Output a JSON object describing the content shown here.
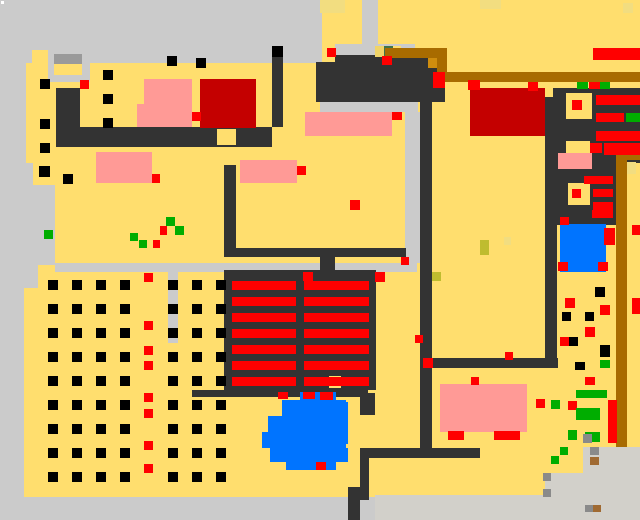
{
  "canvas": {
    "w": 640,
    "h": 520
  },
  "palette": {
    "floor": "#ffde6e",
    "path": "#cbcbcb",
    "path2": "#d2d0ca",
    "roof": "#9a9a9a",
    "wall": "#333333",
    "bed": "#ff9a96",
    "carpet": "#c40000",
    "item": "#ff0000",
    "plant": "#00ad00",
    "water": "#0074ff",
    "wood": "#a86b00",
    "wood2": "#cf8d0e",
    "moss": "#41744a",
    "hay": "#bfbc2f",
    "sand": "#f2dd80",
    "khaki": "#f0d468",
    "rock": "#8a8a8a",
    "dirt": "#a06a32",
    "crop": "#000000",
    "white": "#ffffff"
  },
  "rects": [
    [
      0,
      0,
      640,
      520,
      "floor"
    ],
    [
      0,
      0,
      322,
      63,
      "path"
    ],
    [
      0,
      63,
      26,
      100,
      "path"
    ],
    [
      0,
      163,
      33,
      22,
      "path"
    ],
    [
      0,
      185,
      55,
      80,
      "path"
    ],
    [
      0,
      265,
      38,
      23,
      "path"
    ],
    [
      0,
      288,
      24,
      210,
      "path"
    ],
    [
      0,
      497,
      640,
      23,
      "path"
    ],
    [
      375,
      495,
      265,
      25,
      "path2"
    ],
    [
      583,
      447,
      57,
      50,
      "path2"
    ],
    [
      545,
      473,
      95,
      24,
      "path2"
    ],
    [
      32,
      50,
      16,
      13,
      "floor"
    ],
    [
      48,
      52,
      42,
      30,
      "path"
    ],
    [
      54,
      54,
      28,
      10,
      "roof"
    ],
    [
      54,
      64,
      28,
      11,
      "floor"
    ],
    [
      362,
      0,
      16,
      48,
      "path"
    ],
    [
      335,
      44,
      80,
      18,
      "path"
    ],
    [
      320,
      102,
      98,
      10,
      "path"
    ],
    [
      405,
      112,
      15,
      151,
      "path"
    ],
    [
      55,
      263,
      362,
      9,
      "path"
    ],
    [
      168,
      272,
      10,
      71,
      "path"
    ],
    [
      56,
      88,
      24,
      39,
      "wall"
    ],
    [
      56,
      127,
      216,
      20,
      "wall"
    ],
    [
      224,
      165,
      12,
      83,
      "wall"
    ],
    [
      316,
      62,
      129,
      40,
      "wall"
    ],
    [
      335,
      55,
      95,
      8,
      "wall"
    ],
    [
      272,
      57,
      11,
      70,
      "wall"
    ],
    [
      224,
      248,
      182,
      9,
      "wall"
    ],
    [
      320,
      248,
      15,
      24,
      "wall"
    ],
    [
      420,
      93,
      12,
      357,
      "wall"
    ],
    [
      432,
      358,
      126,
      10,
      "wall"
    ],
    [
      545,
      97,
      12,
      271,
      "wall"
    ],
    [
      553,
      88,
      87,
      74,
      "wall"
    ],
    [
      555,
      162,
      62,
      63,
      "wall"
    ],
    [
      366,
      448,
      114,
      10,
      "wall"
    ],
    [
      360,
      448,
      9,
      52,
      "wall"
    ],
    [
      348,
      487,
      12,
      33,
      "wall"
    ],
    [
      192,
      390,
      176,
      7,
      "wall"
    ],
    [
      360,
      393,
      15,
      22,
      "wall"
    ],
    [
      224,
      270,
      152,
      120,
      "wall"
    ],
    [
      617,
      135,
      23,
      28,
      "wall"
    ],
    [
      217,
      129,
      19,
      16,
      "floor"
    ],
    [
      297,
      129,
      13,
      16,
      "floor"
    ],
    [
      329,
      376,
      12,
      12,
      "floor"
    ],
    [
      566,
      93,
      26,
      26,
      "floor"
    ],
    [
      568,
      183,
      22,
      22,
      "floor"
    ],
    [
      566,
      141,
      24,
      13,
      "floor"
    ],
    [
      428,
      57,
      12,
      11,
      "wood2"
    ],
    [
      375,
      46,
      9,
      11,
      "khaki"
    ],
    [
      384,
      46,
      9,
      11,
      "moss"
    ],
    [
      393,
      46,
      8,
      11,
      "floor"
    ],
    [
      385,
      48,
      62,
      10,
      "wood"
    ],
    [
      437,
      58,
      10,
      16,
      "wood"
    ],
    [
      437,
      72,
      203,
      10,
      "wood"
    ],
    [
      620,
      150,
      20,
      10,
      "wood"
    ],
    [
      616,
      150,
      11,
      297,
      "wood"
    ],
    [
      144,
      79,
      48,
      25,
      "bed"
    ],
    [
      137,
      104,
      55,
      23,
      "bed"
    ],
    [
      96,
      152,
      56,
      31,
      "bed"
    ],
    [
      240,
      160,
      57,
      23,
      "bed"
    ],
    [
      305,
      112,
      87,
      24,
      "bed"
    ],
    [
      558,
      153,
      34,
      16,
      "bed"
    ],
    [
      440,
      384,
      87,
      48,
      "bed"
    ],
    [
      200,
      79,
      56,
      49,
      "carpet"
    ],
    [
      470,
      88,
      75,
      48,
      "carpet"
    ],
    [
      232,
      281,
      64,
      9,
      "item"
    ],
    [
      232,
      297,
      64,
      9,
      "item"
    ],
    [
      232,
      313,
      64,
      9,
      "item"
    ],
    [
      232,
      329,
      64,
      9,
      "item"
    ],
    [
      232,
      345,
      64,
      9,
      "item"
    ],
    [
      232,
      361,
      64,
      9,
      "item"
    ],
    [
      232,
      377,
      64,
      9,
      "item"
    ],
    [
      304,
      281,
      65,
      9,
      "item"
    ],
    [
      304,
      297,
      65,
      9,
      "item"
    ],
    [
      304,
      313,
      65,
      9,
      "item"
    ],
    [
      304,
      329,
      65,
      9,
      "item"
    ],
    [
      304,
      345,
      65,
      9,
      "item"
    ],
    [
      304,
      361,
      65,
      9,
      "item"
    ],
    [
      304,
      377,
      65,
      9,
      "item"
    ],
    [
      596,
      95,
      44,
      10,
      "item"
    ],
    [
      596,
      113,
      28,
      9,
      "item"
    ],
    [
      626,
      113,
      14,
      9,
      "plant"
    ],
    [
      596,
      131,
      44,
      10,
      "item"
    ],
    [
      604,
      143,
      36,
      12,
      "item"
    ],
    [
      590,
      143,
      12,
      10,
      "item"
    ],
    [
      584,
      176,
      29,
      8,
      "item"
    ],
    [
      593,
      189,
      20,
      8,
      "item"
    ],
    [
      593,
      202,
      20,
      8,
      "item"
    ],
    [
      592,
      210,
      21,
      8,
      "item"
    ],
    [
      593,
      48,
      47,
      12,
      "item"
    ],
    [
      608,
      400,
      9,
      43,
      "item"
    ],
    [
      560,
      224,
      46,
      48,
      "water"
    ],
    [
      300,
      392,
      36,
      8,
      "water"
    ],
    [
      282,
      400,
      64,
      16,
      "water"
    ],
    [
      268,
      416,
      80,
      16,
      "water"
    ],
    [
      262,
      432,
      84,
      16,
      "water"
    ],
    [
      270,
      448,
      78,
      14,
      "water"
    ],
    [
      286,
      462,
      50,
      8,
      "water"
    ],
    [
      336,
      402,
      12,
      42,
      "water"
    ],
    [
      80,
      80,
      9,
      9,
      "item"
    ],
    [
      152,
      174,
      8,
      9,
      "item"
    ],
    [
      297,
      166,
      9,
      9,
      "item"
    ],
    [
      392,
      112,
      10,
      8,
      "item"
    ],
    [
      327,
      48,
      9,
      9,
      "item"
    ],
    [
      382,
      56,
      10,
      9,
      "item"
    ],
    [
      433,
      72,
      12,
      16,
      "item"
    ],
    [
      192,
      112,
      9,
      9,
      "item"
    ],
    [
      468,
      80,
      12,
      10,
      "item"
    ],
    [
      350,
      200,
      10,
      10,
      "item"
    ],
    [
      401,
      257,
      8,
      8,
      "item"
    ],
    [
      303,
      272,
      10,
      9,
      "item"
    ],
    [
      375,
      272,
      10,
      10,
      "item"
    ],
    [
      415,
      335,
      8,
      8,
      "item"
    ],
    [
      423,
      358,
      10,
      10,
      "item"
    ],
    [
      471,
      377,
      8,
      8,
      "item"
    ],
    [
      505,
      352,
      8,
      8,
      "item"
    ],
    [
      448,
      431,
      16,
      9,
      "item"
    ],
    [
      494,
      431,
      26,
      9,
      "item"
    ],
    [
      278,
      392,
      10,
      7,
      "item"
    ],
    [
      303,
      392,
      12,
      7,
      "item"
    ],
    [
      320,
      392,
      13,
      8,
      "item"
    ],
    [
      316,
      462,
      10,
      8,
      "item"
    ],
    [
      528,
      82,
      10,
      9,
      "item"
    ],
    [
      589,
      82,
      11,
      7,
      "item"
    ],
    [
      577,
      82,
      11,
      7,
      "plant"
    ],
    [
      600,
      82,
      10,
      7,
      "plant"
    ],
    [
      572,
      100,
      10,
      10,
      "item"
    ],
    [
      572,
      189,
      9,
      9,
      "item"
    ],
    [
      560,
      217,
      9,
      8,
      "item"
    ],
    [
      604,
      228,
      11,
      17,
      "item"
    ],
    [
      558,
      262,
      10,
      9,
      "item"
    ],
    [
      598,
      262,
      10,
      9,
      "item"
    ],
    [
      632,
      225,
      8,
      10,
      "item"
    ],
    [
      632,
      298,
      8,
      16,
      "item"
    ],
    [
      628,
      147,
      10,
      8,
      "item"
    ],
    [
      565,
      298,
      10,
      10,
      "item"
    ],
    [
      600,
      305,
      10,
      10,
      "item"
    ],
    [
      585,
      327,
      10,
      10,
      "item"
    ],
    [
      560,
      337,
      9,
      9,
      "item"
    ],
    [
      536,
      399,
      9,
      9,
      "item"
    ],
    [
      568,
      401,
      9,
      9,
      "item"
    ],
    [
      585,
      377,
      10,
      8,
      "item"
    ],
    [
      44,
      230,
      9,
      9,
      "plant"
    ],
    [
      130,
      233,
      8,
      8,
      "plant"
    ],
    [
      139,
      240,
      8,
      8,
      "plant"
    ],
    [
      153,
      240,
      7,
      8,
      "item"
    ],
    [
      166,
      217,
      9,
      9,
      "plant"
    ],
    [
      175,
      226,
      9,
      9,
      "plant"
    ],
    [
      160,
      226,
      7,
      9,
      "item"
    ],
    [
      551,
      400,
      9,
      9,
      "plant"
    ],
    [
      576,
      390,
      31,
      8,
      "plant"
    ],
    [
      576,
      408,
      24,
      12,
      "plant"
    ],
    [
      568,
      430,
      9,
      10,
      "plant"
    ],
    [
      585,
      432,
      15,
      10,
      "plant"
    ],
    [
      600,
      360,
      10,
      8,
      "plant"
    ],
    [
      560,
      447,
      8,
      8,
      "plant"
    ],
    [
      551,
      456,
      8,
      8,
      "plant"
    ],
    [
      595,
      287,
      10,
      10,
      "crop"
    ],
    [
      562,
      312,
      9,
      9,
      "crop"
    ],
    [
      585,
      312,
      9,
      9,
      "crop"
    ],
    [
      569,
      337,
      9,
      9,
      "crop"
    ],
    [
      600,
      345,
      10,
      12,
      "crop"
    ],
    [
      575,
      362,
      10,
      8,
      "crop"
    ],
    [
      40,
      79,
      10,
      10,
      "crop"
    ],
    [
      40,
      119,
      10,
      10,
      "crop"
    ],
    [
      40,
      143,
      10,
      10,
      "crop"
    ],
    [
      39,
      166,
      11,
      11,
      "crop"
    ],
    [
      63,
      174,
      10,
      10,
      "crop"
    ],
    [
      103,
      70,
      10,
      10,
      "crop"
    ],
    [
      103,
      94,
      10,
      10,
      "crop"
    ],
    [
      103,
      118,
      10,
      10,
      "crop"
    ],
    [
      167,
      56,
      10,
      10,
      "crop"
    ],
    [
      196,
      58,
      10,
      10,
      "crop"
    ],
    [
      272,
      46,
      11,
      11,
      "crop"
    ],
    [
      583,
      434,
      9,
      9,
      "rock"
    ],
    [
      590,
      447,
      9,
      8,
      "rock"
    ],
    [
      590,
      457,
      9,
      8,
      "dirt"
    ],
    [
      543,
      473,
      8,
      8,
      "rock"
    ],
    [
      543,
      489,
      8,
      8,
      "rock"
    ],
    [
      585,
      505,
      8,
      7,
      "rock"
    ],
    [
      593,
      505,
      8,
      7,
      "dirt"
    ],
    [
      320,
      0,
      25,
      13,
      "sand"
    ],
    [
      480,
      0,
      21,
      9,
      "sand"
    ],
    [
      623,
      3,
      10,
      10,
      "sand"
    ],
    [
      627,
      162,
      9,
      12,
      "sand"
    ],
    [
      504,
      237,
      7,
      8,
      "sand"
    ],
    [
      480,
      240,
      9,
      15,
      "hay"
    ],
    [
      432,
      272,
      9,
      9,
      "hay"
    ],
    [
      1,
      1,
      3,
      3,
      "white"
    ]
  ],
  "dot_grid": {
    "color": "crop",
    "size": 10,
    "cols": [
      48,
      72,
      96,
      120,
      168,
      192,
      216
    ],
    "rows": [
      280,
      304,
      328,
      352,
      376,
      400,
      424,
      448,
      472
    ]
  },
  "red_column": {
    "color": "item",
    "size": 9,
    "x": 144,
    "ys": [
      273,
      321,
      346,
      361,
      393,
      409,
      441,
      464
    ]
  }
}
